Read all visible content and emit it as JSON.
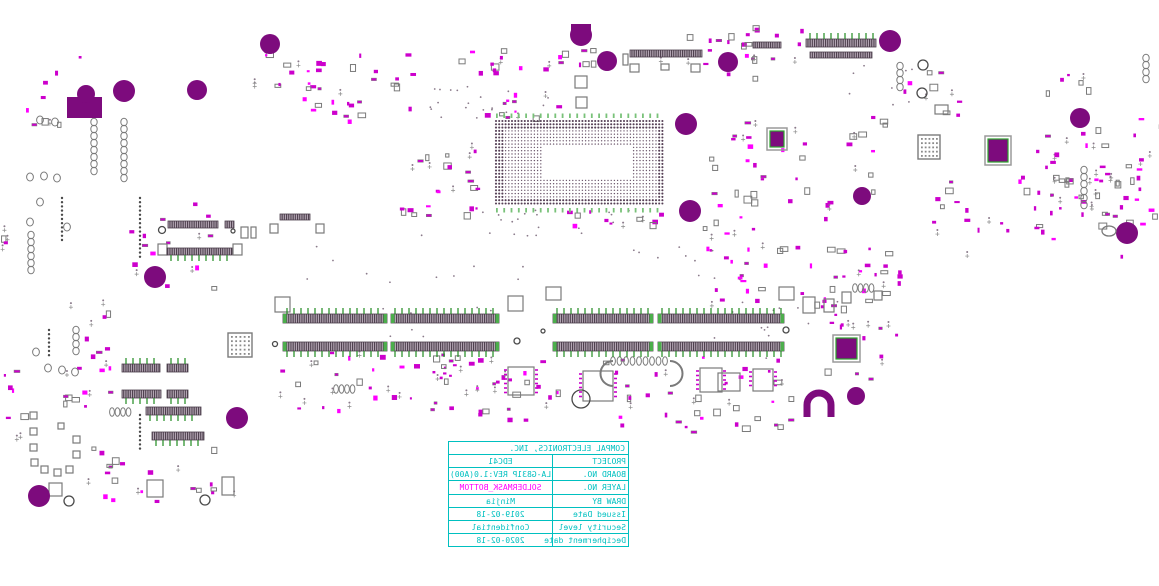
{
  "title_block": {
    "company": "COMPAL ELECTRONICS, INC.",
    "rows": [
      {
        "label": "PROJECT",
        "value": "EDC41"
      },
      {
        "label": "BOARD NO.",
        "value": "LA-G831P REV:1.0(A00)"
      },
      {
        "label": "LAYER NO.",
        "value": "SOLDERMASK_BOTTOM"
      },
      {
        "label": "DRAW BY",
        "value": "Minjia"
      },
      {
        "label": "Issued Date",
        "value": "2019-02-18"
      },
      {
        "label": "Security level",
        "value": "Confidential"
      },
      {
        "label": "Decipherment date",
        "value": "2020-02-18"
      }
    ],
    "text_mirrored": true
  },
  "colors": {
    "background": "#ffffff",
    "table_line_and_text": "#00c0c0",
    "layer_value_text": "#ff00ff",
    "pad_magenta": "#cc00cc",
    "pad_magenta_bright": "#ff00ff",
    "hole_purple": "#7d0b7d",
    "outline_gray": "#7a7a7a",
    "pin_green": "#1f8a1f",
    "bga_tick_green": "#79c279"
  }
}
